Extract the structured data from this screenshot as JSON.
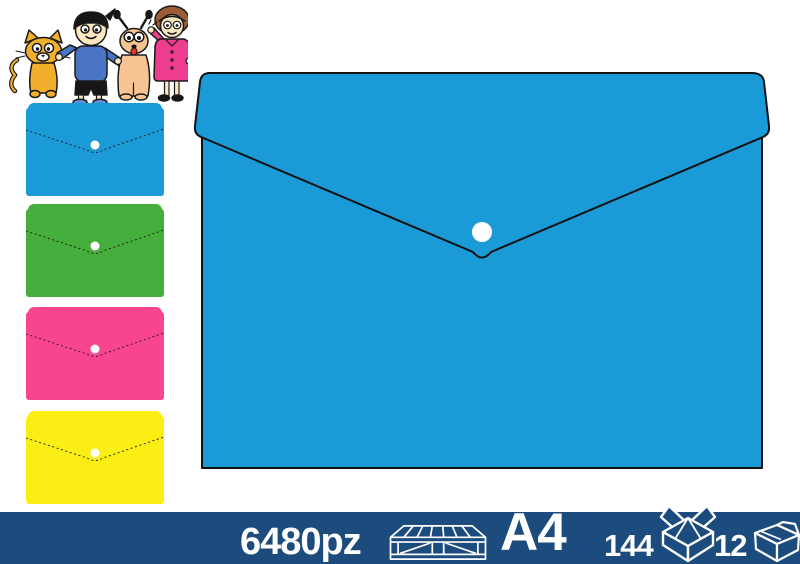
{
  "page": {
    "background": "#ffffff"
  },
  "cartoon": {
    "label": "family-with-pets-illustration",
    "colors": {
      "outline": "#1a1a1a",
      "cat": "#F2AF2B",
      "skin": "#FBE7C0",
      "boy_shirt": "#4A75C5",
      "boy_shoes": "#5B8FD6",
      "dog": "#F6C492",
      "tongue": "#E2382F",
      "grandma_coat": "#EE3D8F",
      "hair_brown": "#9A5B35",
      "black_parts": "#161616"
    }
  },
  "variants": {
    "button_color": "#FFFFFF",
    "fold_line_color": "#1a1a1a",
    "items": [
      {
        "name": "blue",
        "color": "#1B9AD8"
      },
      {
        "name": "green",
        "color": "#46AE3C"
      },
      {
        "name": "pink",
        "color": "#F9448F"
      },
      {
        "name": "yellow",
        "color": "#FAEE14"
      }
    ]
  },
  "main_product": {
    "label": "a4-snap-button-envelope",
    "color": "#1B9AD8",
    "outline": "#111111",
    "button_color": "#FFFFFF"
  },
  "footer": {
    "bar_color": "#1C4B7D",
    "text_color": "#FFFFFF",
    "pallet_quantity": "6480pz",
    "format": "A4",
    "pack_quantity": "144",
    "carton_quantity": "12",
    "icons": [
      "pallet-icon",
      "open-box-icon",
      "carton-box-icon"
    ]
  }
}
